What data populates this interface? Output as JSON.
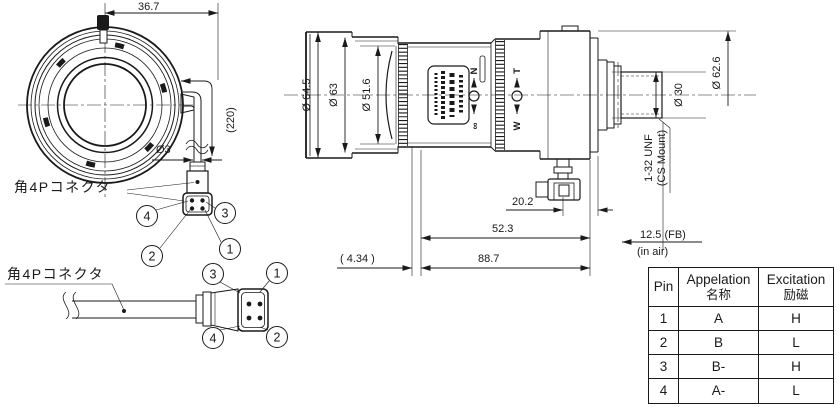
{
  "front_view": {
    "dim_top": "36.7",
    "cable_length": "(220)",
    "cable_dia": "Ø3",
    "connector_label": "角4Pコネクタ",
    "callouts": [
      "4",
      "3",
      "2",
      "1"
    ]
  },
  "cable_assembly": {
    "connector_label": "角4Pコネクタ",
    "callouts": [
      "3",
      "1",
      "4",
      "2"
    ]
  },
  "side_view": {
    "dia_outer": "Ø 64.5",
    "dia_mid": "Ø 63",
    "dia_front_group": "Ø 51.6",
    "dia_rear_cyl": "Ø 30",
    "dia_rear_barrel": "Ø 62.6",
    "mount_thread": "1-32 UNF",
    "mount_type": "(CS Mount)",
    "dim_connector": "20.2",
    "dim_rear_section": "52.3",
    "dim_total": "88.7",
    "dim_vertex": "( 4.34 )",
    "flange_back": "12.5 (FB)",
    "flange_back_note": "(in air)",
    "focus_near": "N",
    "focus_infinity": "∞",
    "zoom_tele": "T",
    "zoom_wide": "W"
  },
  "pin_table": {
    "col_pin": "Pin",
    "col_appelation_en": "Appelation",
    "col_appelation_jp": "名称",
    "col_excitation_en": "Excitation",
    "col_excitation_jp": "励磁",
    "rows": [
      {
        "pin": "1",
        "appelation": "A",
        "excitation": "H"
      },
      {
        "pin": "2",
        "appelation": "B",
        "excitation": "L"
      },
      {
        "pin": "3",
        "appelation": "B-",
        "excitation": "H"
      },
      {
        "pin": "4",
        "appelation": "A-",
        "excitation": "L"
      }
    ]
  },
  "colors": {
    "line": "#1a1a1a",
    "background": "#ffffff"
  }
}
